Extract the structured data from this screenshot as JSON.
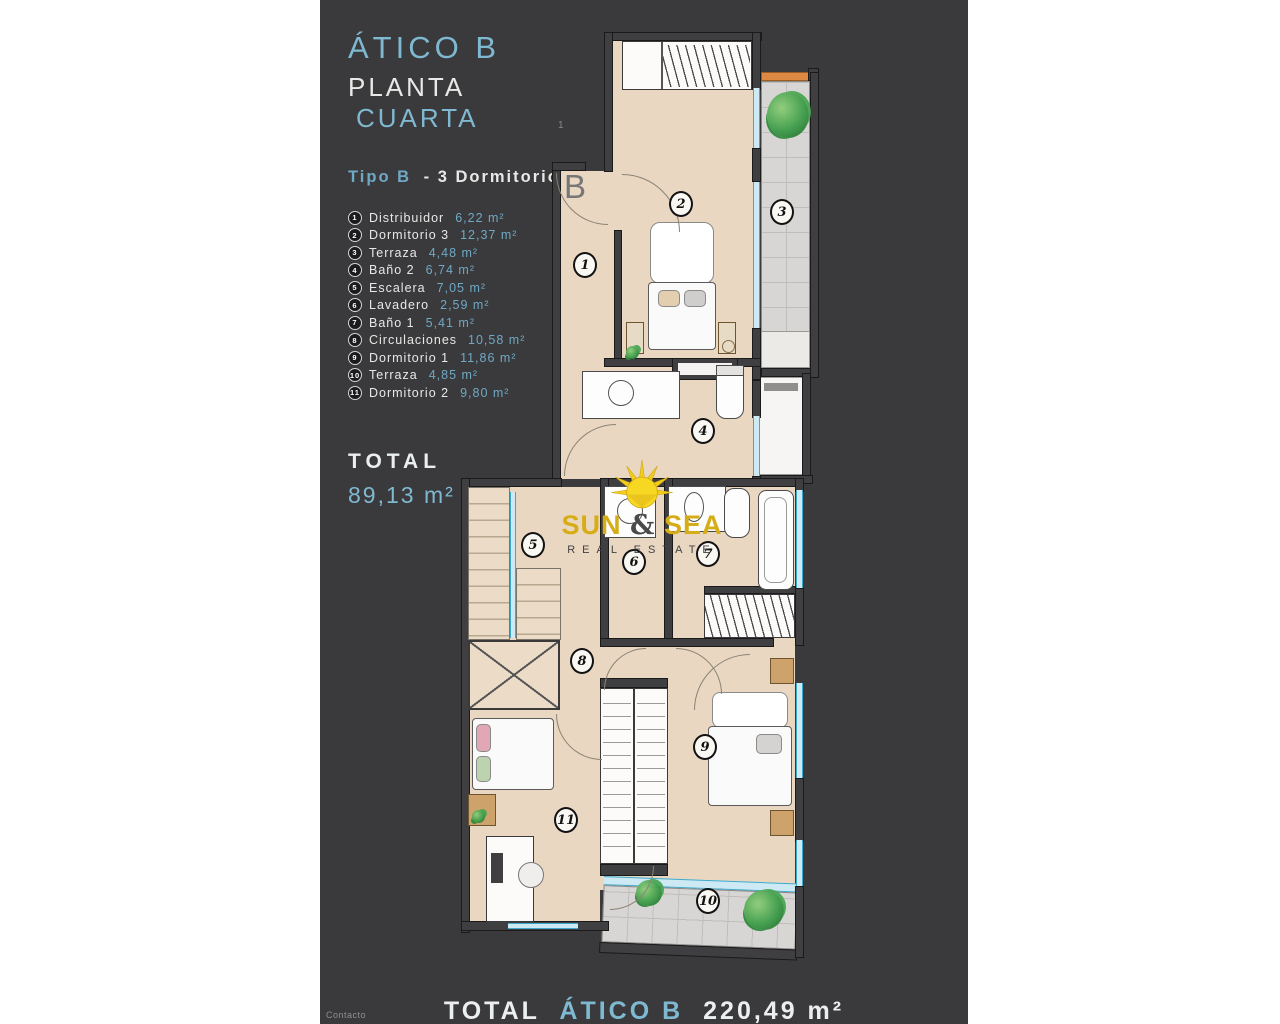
{
  "colors": {
    "panel": "#3a393b",
    "accent_blue": "#7fb9d1",
    "legend_blue": "#6fa9c6",
    "gold": "#d7ad17",
    "floor_beige": "#e9d7c1"
  },
  "header": {
    "title": "ÁTICO B",
    "floor_word": "PLANTA",
    "floor_name": "CUARTA"
  },
  "type_line": {
    "highlight": "Tipo B",
    "rest": "- 3 Dormitorios"
  },
  "legend": {
    "items": [
      {
        "num": "1",
        "name": "Distribuidor",
        "area": "6,22 m²"
      },
      {
        "num": "2",
        "name": "Dormitorio 3",
        "area": "12,37 m²"
      },
      {
        "num": "3",
        "name": "Terraza",
        "area": "4,48 m²"
      },
      {
        "num": "4",
        "name": "Baño 2",
        "area": "6,74 m²"
      },
      {
        "num": "5",
        "name": "Escalera",
        "area": "7,05 m²"
      },
      {
        "num": "6",
        "name": "Lavadero",
        "area": "2,59 m²"
      },
      {
        "num": "7",
        "name": "Baño 1",
        "area": "5,41 m²"
      },
      {
        "num": "8",
        "name": "Circulaciones",
        "area": "10,58 m²"
      },
      {
        "num": "9",
        "name": "Dormitorio 1",
        "area": "11,86 m²"
      },
      {
        "num": "10",
        "name": "Terraza",
        "area": "4,85 m²"
      },
      {
        "num": "11",
        "name": "Dormitorio 2",
        "area": "9,80 m²"
      }
    ]
  },
  "total": {
    "label": "TOTAL",
    "value": "89,13 m²"
  },
  "watermark": {
    "word1": "SUN",
    "amp": "&",
    "word2": "SEA",
    "subtitle": "REAL ESTATE"
  },
  "plan": {
    "unit_label": "B",
    "floor_marker": "1",
    "markers": [
      "1",
      "2",
      "3",
      "4",
      "5",
      "6",
      "7",
      "8",
      "9",
      "10",
      "11"
    ]
  },
  "footer": {
    "label": "TOTAL",
    "highlight": "ÁTICO B",
    "value": "220,49 m²"
  },
  "contact": {
    "label": "Contacto"
  }
}
